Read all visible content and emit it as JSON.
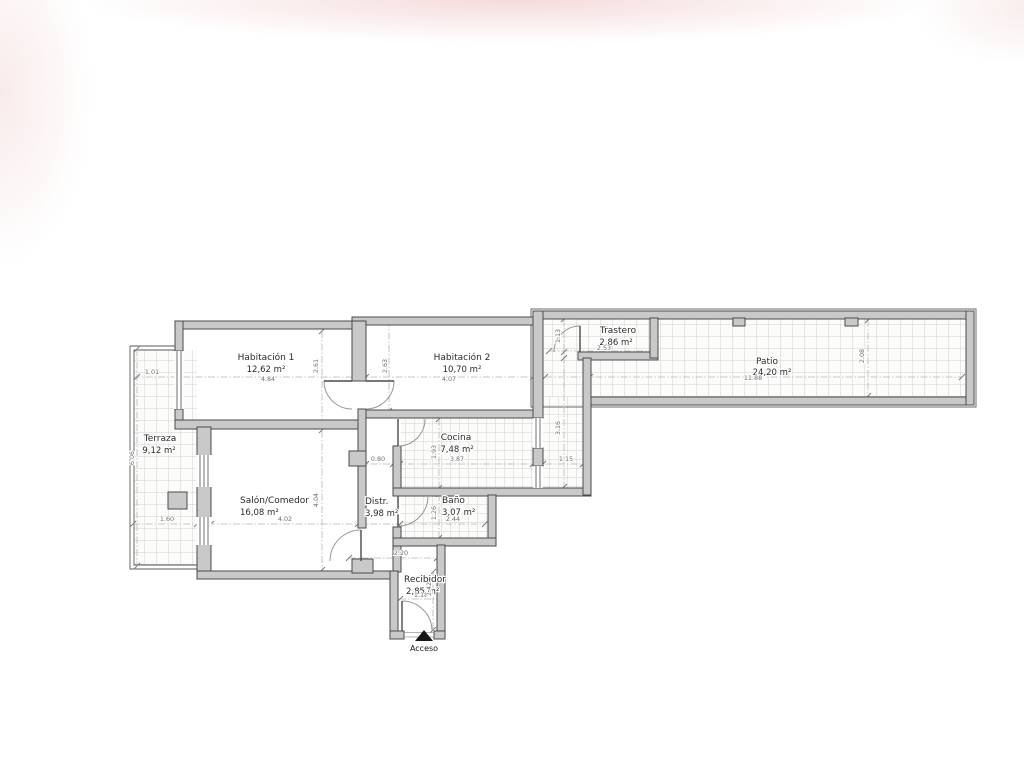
{
  "plan": {
    "rooms": [
      {
        "name": "Habitación 1",
        "area": "12,62 m²"
      },
      {
        "name": "Habitación 2",
        "area": "10,70 m²"
      },
      {
        "name": "Trastero",
        "area": "2,86 m²"
      },
      {
        "name": "Patio",
        "area": "24,20 m²"
      },
      {
        "name": "Terraza",
        "area": "9,12 m²"
      },
      {
        "name": "Cocina",
        "area": "7,48 m²"
      },
      {
        "name": "Salón/Comedor",
        "area": "16,08 m²"
      },
      {
        "name": "Distr.",
        "area": "3,98 m²"
      },
      {
        "name": "Baño",
        "area": "3,07 m²"
      },
      {
        "name": "Recibidor",
        "area": "2,85 m²"
      }
    ],
    "entrance_label": "Acceso",
    "dims": [
      {
        "v": "1.01"
      },
      {
        "v": "4.84"
      },
      {
        "v": "4.07"
      },
      {
        "v": "2.53"
      },
      {
        "v": "11.88"
      },
      {
        "v": "1.60"
      },
      {
        "v": "4.02"
      },
      {
        "v": "0.80"
      },
      {
        "v": "3.87"
      },
      {
        "v": "1.15"
      },
      {
        "v": "2.44"
      },
      {
        "v": "2.20"
      },
      {
        "v": "1.18"
      },
      {
        "v": "6.06"
      },
      {
        "v": "2.61"
      },
      {
        "v": "2.63"
      },
      {
        "v": "4.04"
      },
      {
        "v": "1.93"
      },
      {
        "v": "1.26"
      },
      {
        "v": "3.16"
      },
      {
        "v": "1.13"
      },
      {
        "v": "2.08"
      },
      {
        "v": "2.42"
      }
    ],
    "colors": {
      "wall_fill": "#c9c9c9",
      "wall_stroke": "#4a4a4a",
      "tile_line": "#d0d0cd",
      "dim_line": "#b5b5b5",
      "text": "#2a2a2a"
    }
  }
}
